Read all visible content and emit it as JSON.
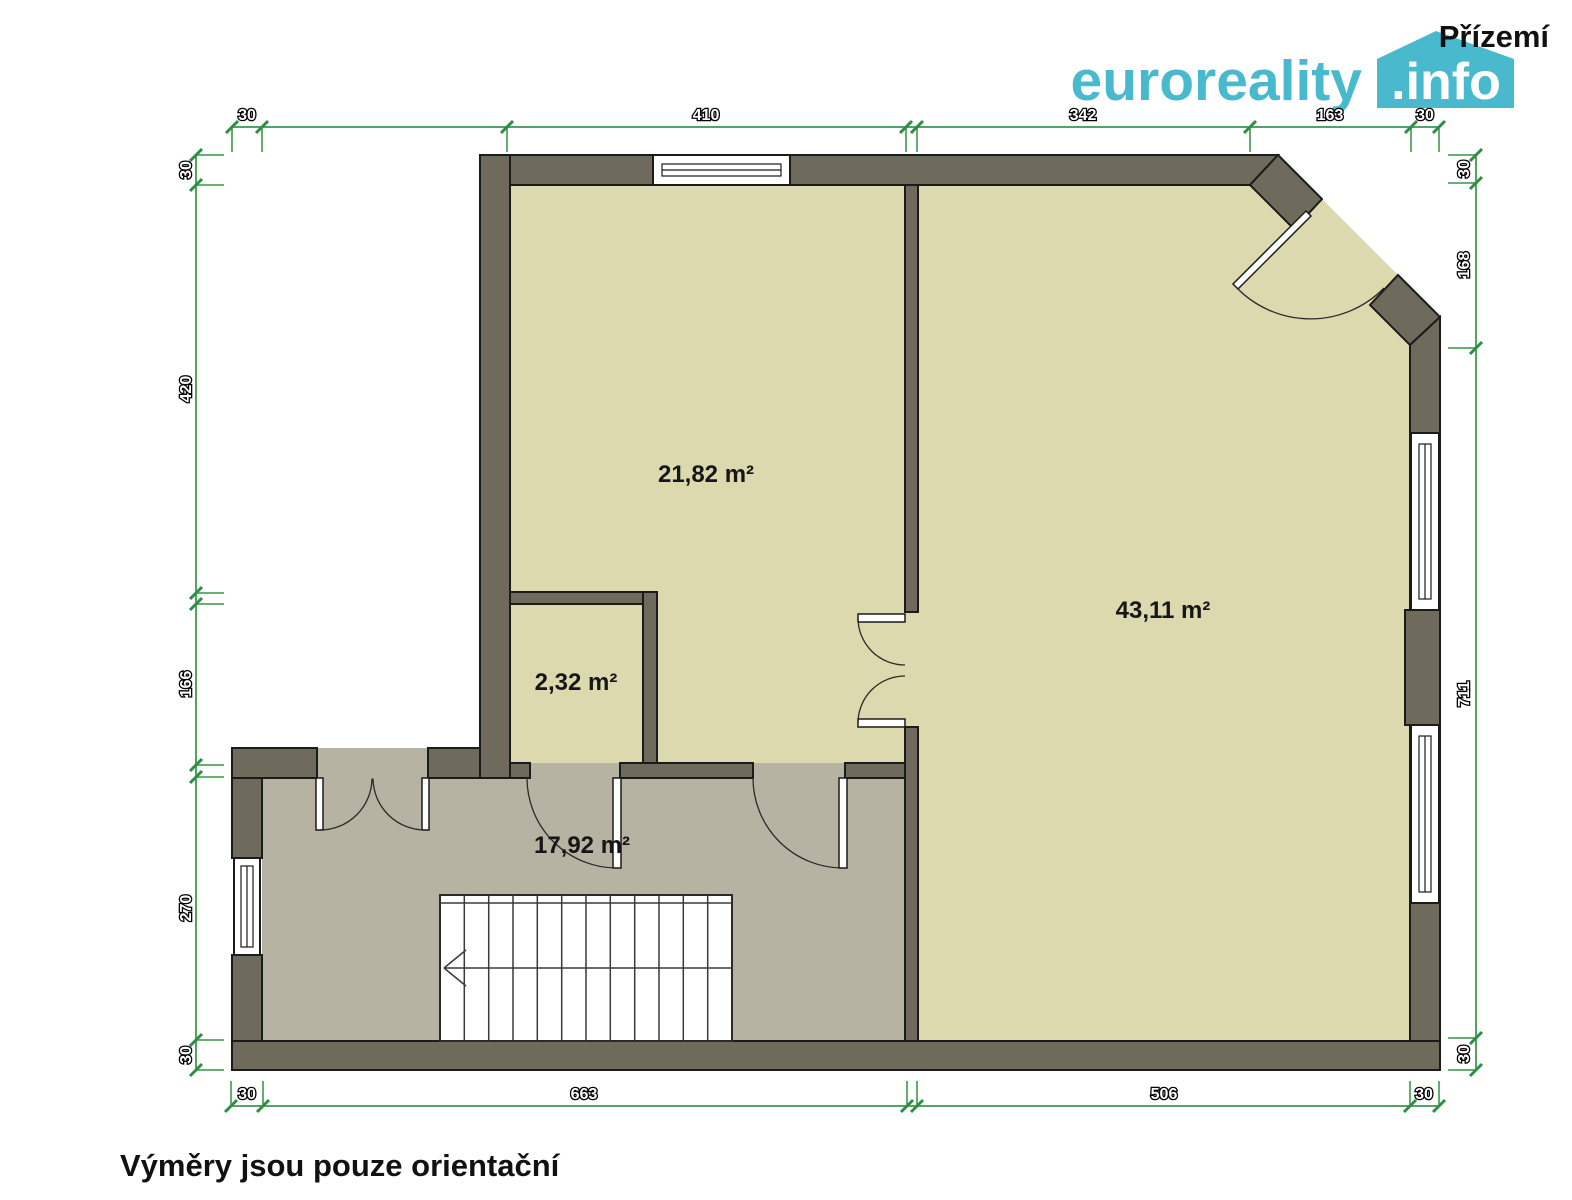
{
  "header": {
    "floor_title": "Přízemí",
    "logo": {
      "name": "euroreality",
      "badge": ".info"
    }
  },
  "rooms": [
    {
      "name": "upper-left-room",
      "area_label": "21,82 m²"
    },
    {
      "name": "closet",
      "area_label": "2,32 m²"
    },
    {
      "name": "main-room",
      "area_label": "43,11 m²"
    },
    {
      "name": "hallway",
      "area_label": "17,92 m²"
    }
  ],
  "dimensions": {
    "top": [
      "30",
      "410",
      "342",
      "163",
      "30"
    ],
    "left": [
      "30",
      "420",
      "166",
      "270",
      "30"
    ],
    "right": [
      "30",
      "168",
      "711",
      "30"
    ],
    "bottom": [
      "30",
      "663",
      "506",
      "30"
    ]
  },
  "footer": {
    "note": "Výměry jsou pouze orientační"
  },
  "colors": {
    "logo_teal": "#49b9ce",
    "dimension_green": "#54a362",
    "wall": "#6f6b5c",
    "room_floor": "#dcd9af",
    "hall_floor": "#b6b3a2"
  }
}
